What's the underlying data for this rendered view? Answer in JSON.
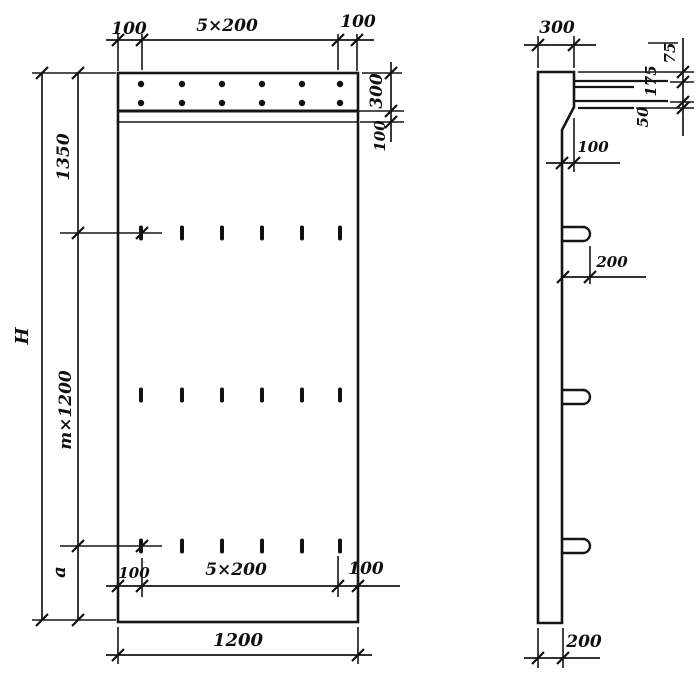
{
  "title": "Reinforced panel working drawing, front and side views",
  "colors": {
    "background": "#ffffff",
    "ink": "#161616"
  },
  "front_view": {
    "name": "front view",
    "features": {
      "anchor_dot_rows": 2,
      "anchor_dots_per_row": 6,
      "slot_rows": 3,
      "slots_per_row": 6
    },
    "dims": {
      "top_left": "100",
      "top_span": "5×200",
      "top_right": "100",
      "band_height": "300",
      "band_offset": "100",
      "left_top": "1350",
      "left_total": "H",
      "left_module": "m×1200",
      "left_bottom": "a",
      "inner_left": "100",
      "inner_span": "5×200",
      "inner_right": "100",
      "width": "1200"
    }
  },
  "side_view": {
    "name": "side view",
    "features": {
      "lifting_loops": 3,
      "protruding_bars": 2
    },
    "dims": {
      "top_width": "300",
      "right_top": "75",
      "right_mid": "175",
      "right_bottom": "50",
      "ledge_offset": "100",
      "loop_length": "200",
      "bottom_thickness": "200"
    }
  }
}
